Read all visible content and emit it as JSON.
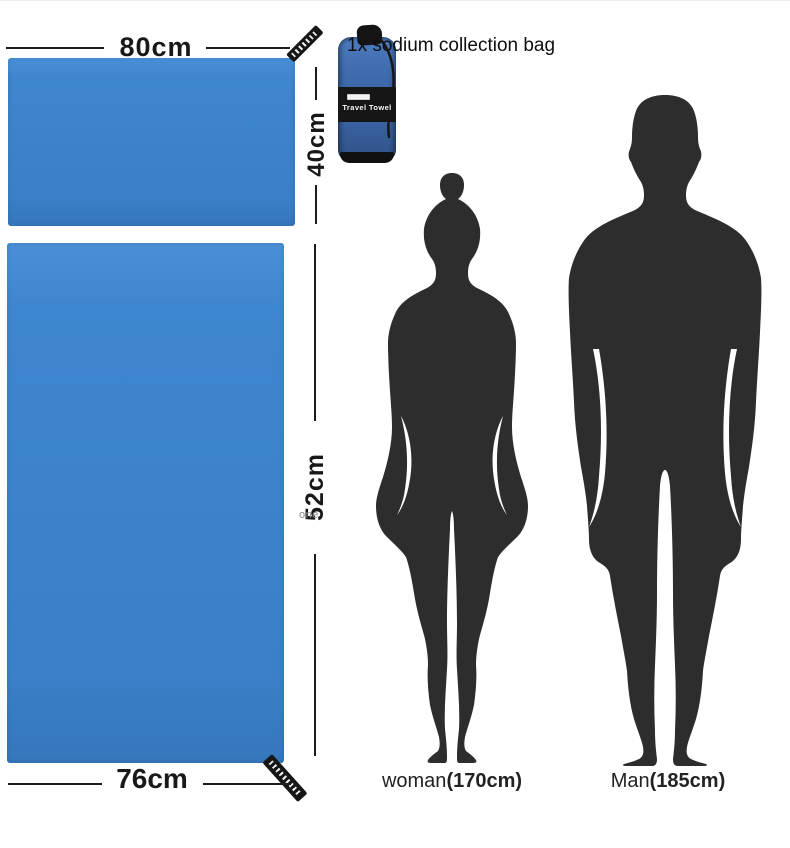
{
  "title": "1x sodium collection bag",
  "colors": {
    "towel_blue": "#3e86cf",
    "bag_blue": "#3f6cae",
    "silhouette_dark": "#2d2d2d",
    "tag_black": "#161616",
    "text_dark": "#1b1b1b"
  },
  "bag": {
    "label": "Travel Towel"
  },
  "dimensions": {
    "small_towel_width": "80cm",
    "small_towel_height": "40cm",
    "large_towel_height": "52cm",
    "large_towel_height_prefix": "one",
    "large_towel_width": "76cm"
  },
  "figures": {
    "woman_name": "woman",
    "woman_height": "(170cm)",
    "man_name": "Man",
    "man_height": "(185cm)"
  },
  "icons": {
    "hang_tag": "brand-hang-tag",
    "bag": "travel-towel-stuff-sack"
  }
}
